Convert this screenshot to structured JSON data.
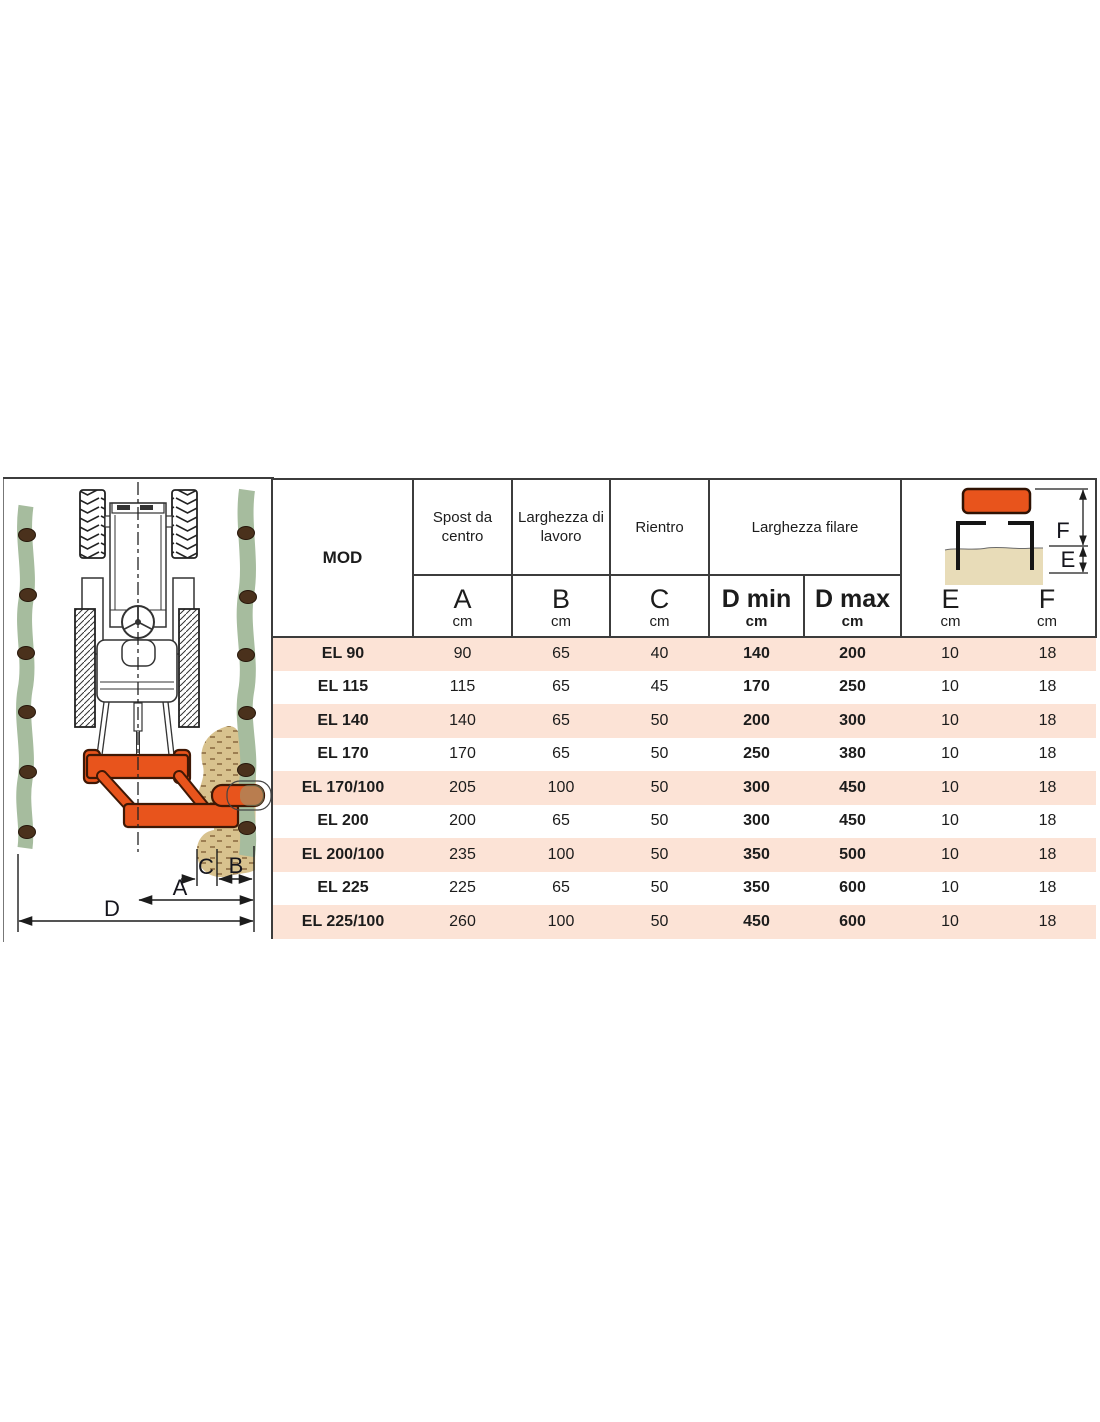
{
  "colors": {
    "accent_orange": "#E8541C",
    "row_pink": "#FCE3D6",
    "vine_green": "#A6BC9E",
    "soil_tan": "#D8C28E",
    "soil_light": "#E8DCB8",
    "border_dark": "#3C3C3C"
  },
  "left_diagram": {
    "labels": {
      "a": "A",
      "b": "B",
      "c": "C",
      "d": "D"
    }
  },
  "mini_diagram": {
    "labels": {
      "e": "E",
      "f": "F"
    }
  },
  "table": {
    "header": {
      "mod": "MOD",
      "groups": {
        "spost": "Spost da centro",
        "larghezza": "Larghezza di lavoro",
        "rientro": "Rientro",
        "filare": "Larghezza filare"
      },
      "cols": {
        "a": {
          "letter": "A",
          "unit": "cm"
        },
        "b": {
          "letter": "B",
          "unit": "cm"
        },
        "c": {
          "letter": "C",
          "unit": "cm"
        },
        "dmin": {
          "letter": "D min",
          "unit": "cm"
        },
        "dmax": {
          "letter": "D max",
          "unit": "cm"
        },
        "e": {
          "letter": "E",
          "unit": "cm"
        },
        "f": {
          "letter": "F",
          "unit": "cm"
        }
      }
    },
    "rows": [
      {
        "model": "EL 90",
        "a": "90",
        "b": "65",
        "c": "40",
        "dmin": "140",
        "dmax": "200",
        "e": "10",
        "f": "18"
      },
      {
        "model": "EL 115",
        "a": "115",
        "b": "65",
        "c": "45",
        "dmin": "170",
        "dmax": "250",
        "e": "10",
        "f": "18"
      },
      {
        "model": "EL 140",
        "a": "140",
        "b": "65",
        "c": "50",
        "dmin": "200",
        "dmax": "300",
        "e": "10",
        "f": "18"
      },
      {
        "model": "EL 170",
        "a": "170",
        "b": "65",
        "c": "50",
        "dmin": "250",
        "dmax": "380",
        "e": "10",
        "f": "18"
      },
      {
        "model": "EL 170/100",
        "a": "205",
        "b": "100",
        "c": "50",
        "dmin": "300",
        "dmax": "450",
        "e": "10",
        "f": "18"
      },
      {
        "model": "EL 200",
        "a": "200",
        "b": "65",
        "c": "50",
        "dmin": "300",
        "dmax": "450",
        "e": "10",
        "f": "18"
      },
      {
        "model": "EL 200/100",
        "a": "235",
        "b": "100",
        "c": "50",
        "dmin": "350",
        "dmax": "500",
        "e": "10",
        "f": "18"
      },
      {
        "model": "EL 225",
        "a": "225",
        "b": "65",
        "c": "50",
        "dmin": "350",
        "dmax": "600",
        "e": "10",
        "f": "18"
      },
      {
        "model": "EL 225/100",
        "a": "260",
        "b": "100",
        "c": "50",
        "dmin": "450",
        "dmax": "600",
        "e": "10",
        "f": "18"
      }
    ]
  }
}
